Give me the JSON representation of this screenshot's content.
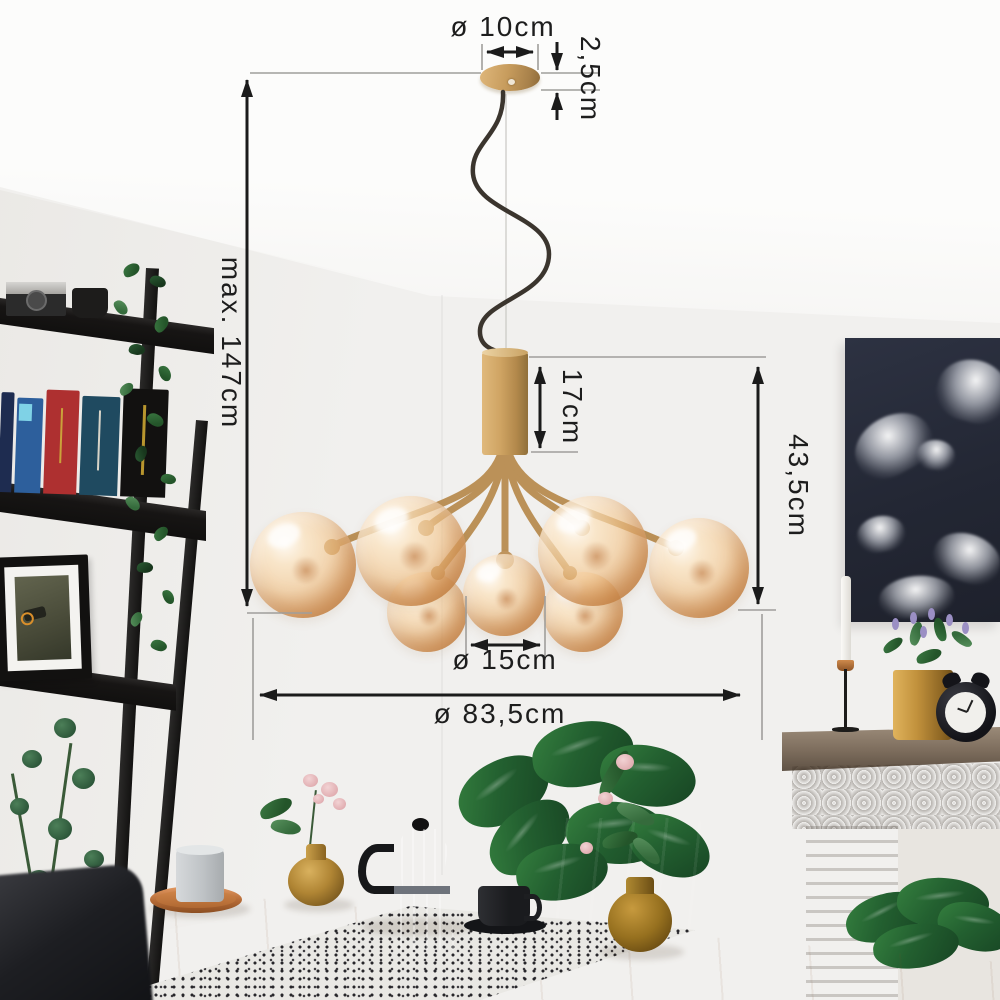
{
  "scene": {
    "type": "product-photo",
    "subject": "Brass pendant chandelier with amber glass globes hanging in a living room above a wooden dining table"
  },
  "annotations": {
    "canopy_diameter": "ø 10cm",
    "canopy_height": "2,5cm",
    "max_hanging_height": "max. 147cm",
    "stem_height": "17cm",
    "fixture_height": "43,5cm",
    "globe_diameter": "ø 15cm",
    "fixture_diameter": "ø 83,5cm"
  },
  "colors": {
    "dimension_line": "#1b1b1b",
    "extension_line": "#9f9e9b",
    "brass": "#c79c5d",
    "amber_glass": "#f3c489",
    "wall": "#f1f0ee",
    "ceiling": "#fcfcfb",
    "table_wood": "#d8a678",
    "artwork_background": "#232734"
  }
}
